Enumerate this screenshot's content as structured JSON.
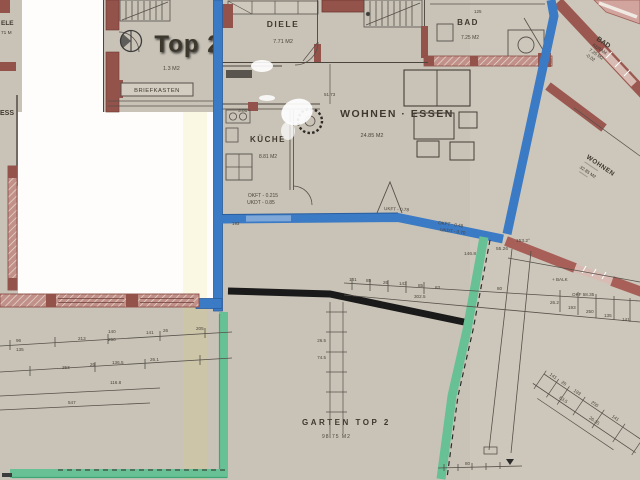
{
  "overlay": {
    "unit_label": "Top 2"
  },
  "rooms": {
    "diele": {
      "name": "DIELE",
      "area": "7.71 M2"
    },
    "kueche": {
      "name": "KÜCHE",
      "area": "8.81 M2"
    },
    "wohnen_essen": {
      "name": "WOHNEN · ESSEN",
      "area": "24.85 M2"
    },
    "bad": {
      "name": "BAD",
      "area": "7.25 M2"
    },
    "bad_right": {
      "name": "BAD",
      "material": "KERAM.",
      "area": "7.25 M2",
      "level": "-0.02"
    },
    "wohnen_right": {
      "name": "WOHNEN",
      "area": "32.85 M2"
    },
    "garten": {
      "name": "GARTEN  TOP 2",
      "area": "98.75 M2"
    },
    "vorraum": {
      "area": "1.3 M2"
    },
    "briefkasten": {
      "label": "BRIEFKASTEN"
    },
    "edge_cut": {
      "diele_fragment": "ELE",
      "area_fragment": "71 M",
      "essen_fragment": "ESS"
    }
  },
  "annotations": {
    "kueche_floor": "OKFT - 0.215",
    "kueche_ceiling": "UKDT - 0.85",
    "terrace_1": "UKFT - 0.78",
    "terrace_2": "OKFT - 0.48",
    "terrace_3": "UKDT - 0.70",
    "angle_left": "146.8",
    "angle_right": "153.2°",
    "len_mid": "55.26",
    "balk": "+ BALK",
    "okf": "OKF 58.35"
  },
  "dims": {
    "v96": "96",
    "v135": "135",
    "v213": "213",
    "v140": "140",
    "v250": "250",
    "v141": "141",
    "v26": "26",
    "v205": "205",
    "v26_1": "26.1",
    "v253": "253",
    "v136_5": "136.5",
    "v116_8": "116.8",
    "v547": "547",
    "v302_5": "302.5",
    "v85": "85",
    "v143": "143",
    "v83": "83",
    "v80": "80",
    "v26_2": "26.2",
    "v193": "193",
    "v26_5": "26.5",
    "v74_5": "74.5",
    "v51_73": "51.73",
    "v3_01": "3.01",
    "v125": "125",
    "v83_5": "83.5",
    "v26_35": "26.35"
  },
  "colors": {
    "paper": "#c9c3b7",
    "white_mask": "#fefdfb",
    "wall_maroon": "#93524a",
    "wall_pink": "#c19088",
    "highlight_blue": "#3b7ac4",
    "highlight_green": "#68c095",
    "heavy_black": "#1a1a1a"
  }
}
